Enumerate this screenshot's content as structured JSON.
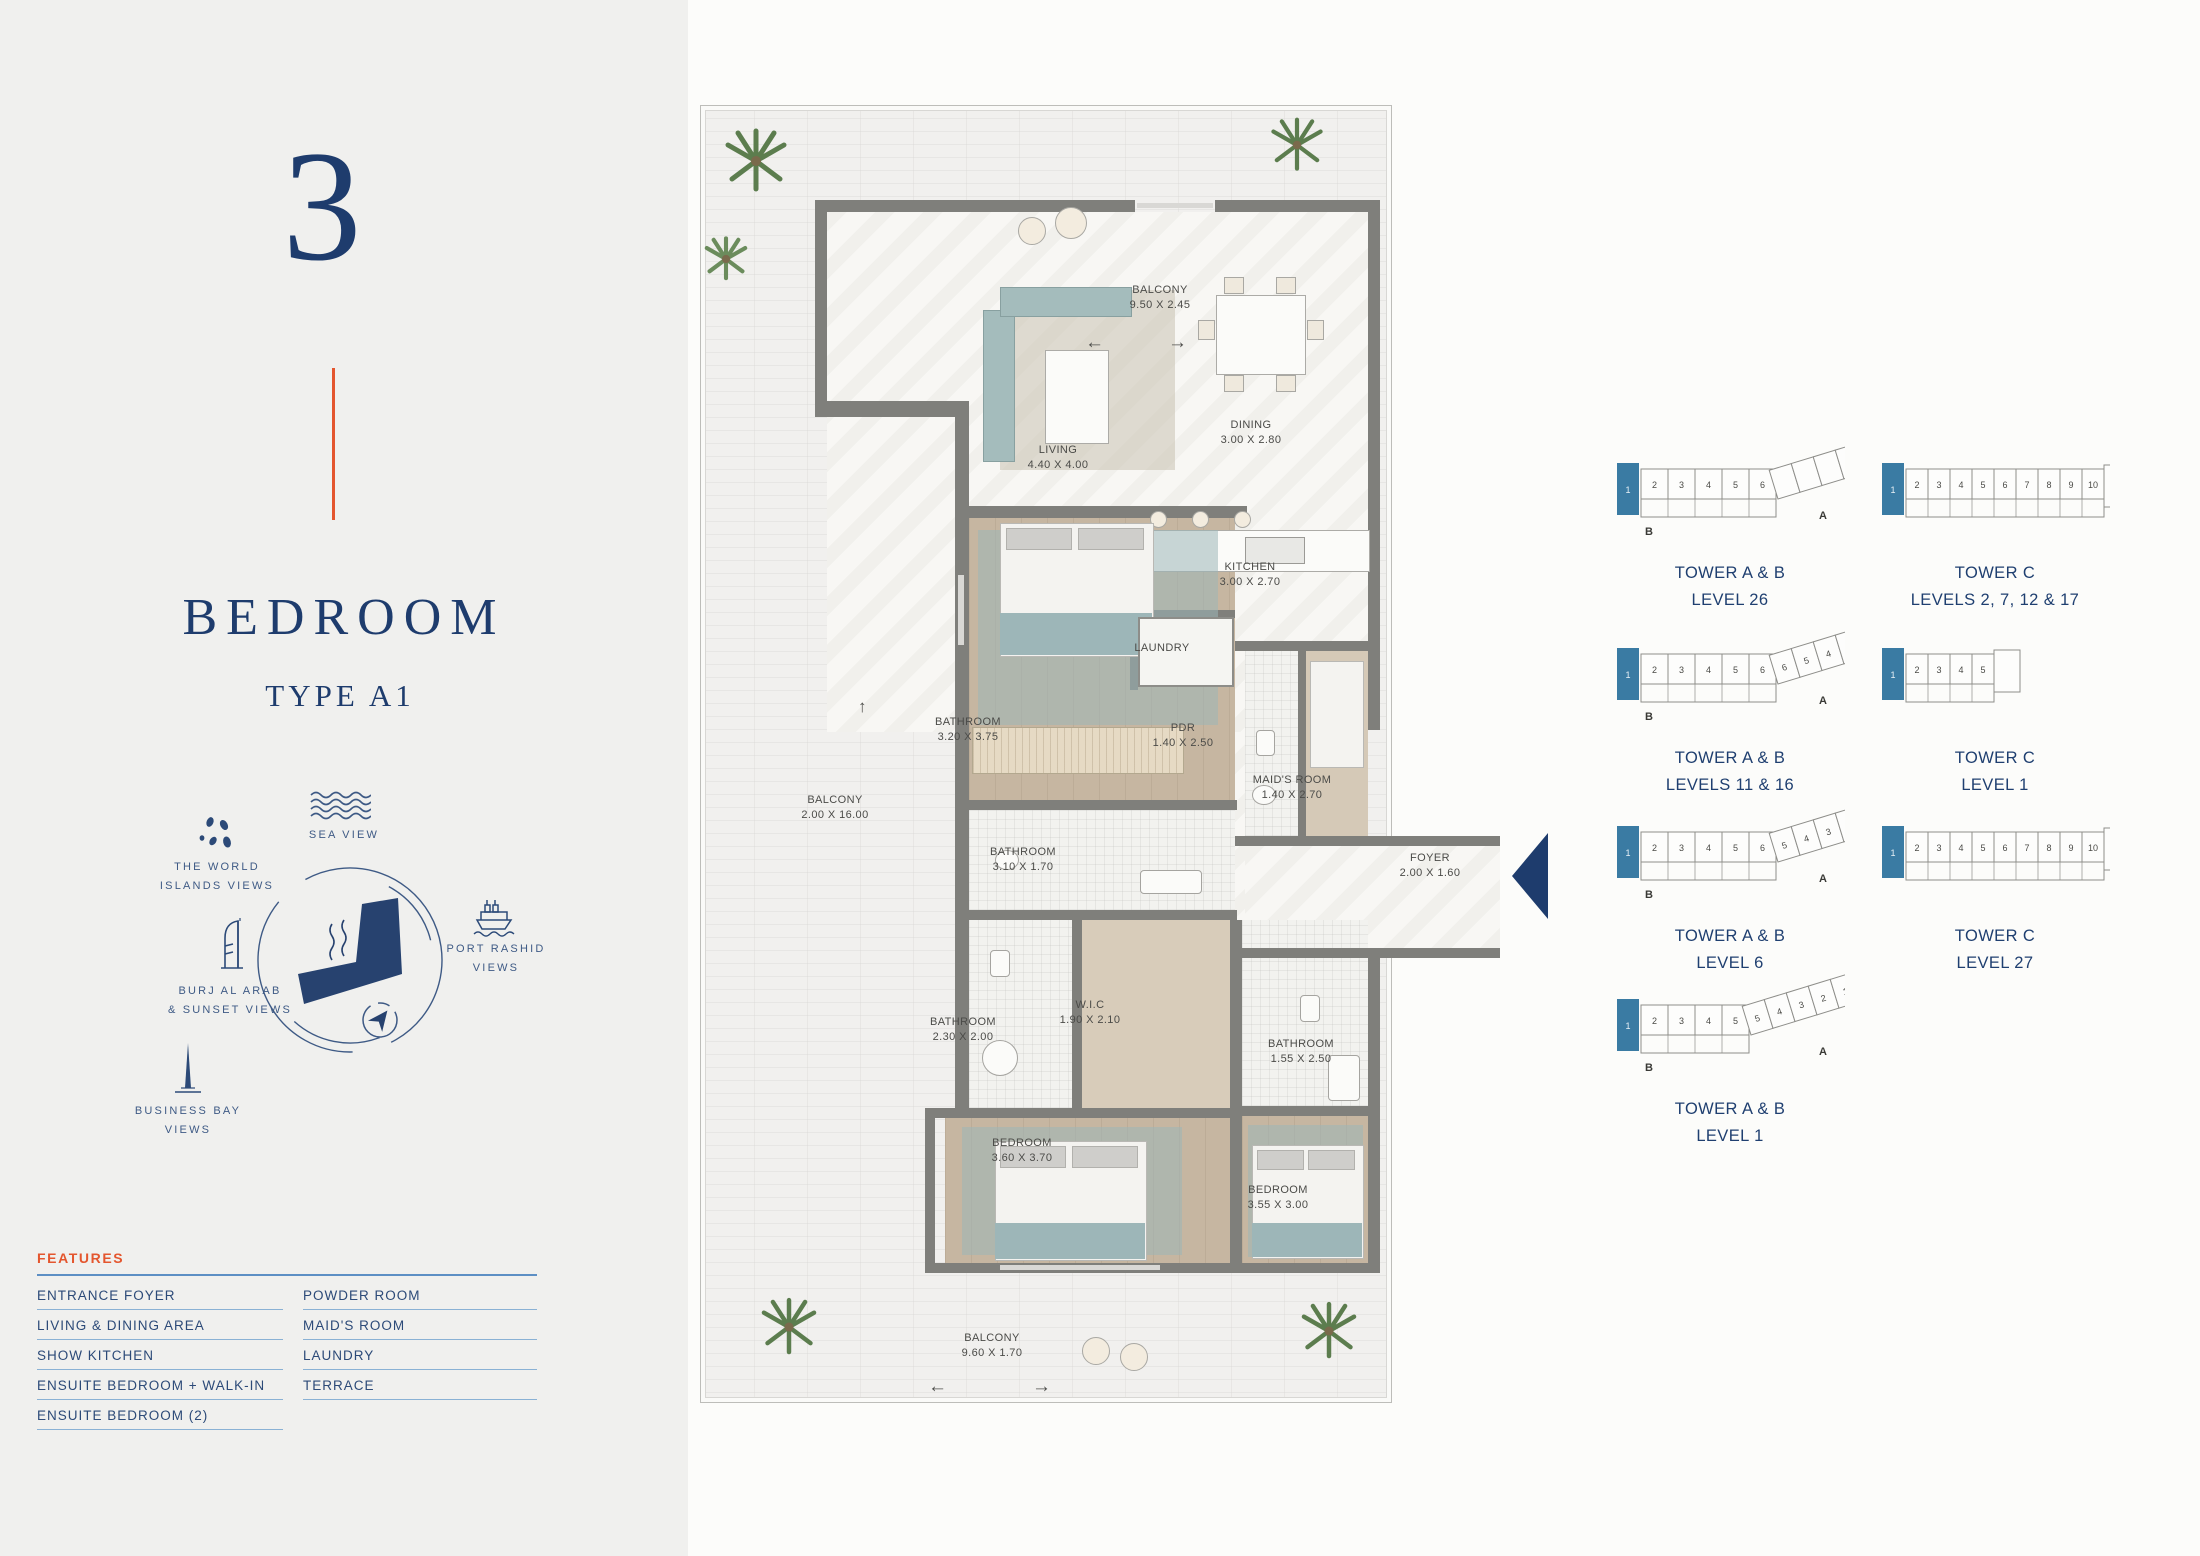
{
  "page": {
    "unit_number": "3",
    "title": "BEDROOM",
    "subtitle": "TYPE A1"
  },
  "views": {
    "sea": [
      "SEA VIEW"
    ],
    "world": [
      "THE WORLD",
      "ISLANDS VIEWS"
    ],
    "port": [
      "PORT RASHID",
      "VIEWS"
    ],
    "burj": [
      "BURJ AL ARAB",
      "& SUNSET VIEWS"
    ],
    "bay": [
      "BUSINESS BAY",
      "VIEWS"
    ]
  },
  "features": {
    "heading": "FEATURES",
    "left": [
      "ENTRANCE FOYER",
      "LIVING & DINING AREA",
      "SHOW KITCHEN",
      "ENSUITE BEDROOM + WALK-IN",
      "ENSUITE BEDROOM (2)"
    ],
    "right": [
      "POWDER ROOM",
      "MAID'S ROOM",
      "LAUNDRY",
      "TERRACE"
    ]
  },
  "floorplan": {
    "north_arrow": "↑",
    "arrow_left": "←",
    "arrow_right": "→",
    "rooms": [
      {
        "n": "BALCONY",
        "d": "9.50 X 2.45",
        "x": 460,
        "y": 178
      },
      {
        "n": "LIVING",
        "d": "4.40 X 4.00",
        "x": 358,
        "y": 338
      },
      {
        "n": "DINING",
        "d": "3.00 X 2.80",
        "x": 551,
        "y": 313
      },
      {
        "n": "KITCHEN",
        "d": "3.00 X 2.70",
        "x": 550,
        "y": 455
      },
      {
        "n": "LAUNDRY",
        "d": "",
        "x": 462,
        "y": 536
      },
      {
        "n": "BATHROOM",
        "d": "3.20 X 3.75",
        "x": 268,
        "y": 610
      },
      {
        "n": "PDR",
        "d": "1.40 X 2.50",
        "x": 483,
        "y": 616
      },
      {
        "n": "MAID'S ROOM",
        "d": "1.40 X 2.70",
        "x": 592,
        "y": 668
      },
      {
        "n": "BALCONY",
        "d": "2.00 X 16.00",
        "x": 135,
        "y": 688
      },
      {
        "n": "BATHROOM",
        "d": "3.10 X 1.70",
        "x": 323,
        "y": 740
      },
      {
        "n": "FOYER",
        "d": "2.00 X 1.60",
        "x": 730,
        "y": 746
      },
      {
        "n": "BATHROOM",
        "d": "2.30 X 2.00",
        "x": 263,
        "y": 910
      },
      {
        "n": "W.I.C",
        "d": "1.90 X 2.10",
        "x": 390,
        "y": 893
      },
      {
        "n": "BATHROOM",
        "d": "1.55 X 2.50",
        "x": 601,
        "y": 932
      },
      {
        "n": "BEDROOM",
        "d": "3.60 X 3.70",
        "x": 322,
        "y": 1031
      },
      {
        "n": "BEDROOM",
        "d": "3.55 X 3.00",
        "x": 578,
        "y": 1078
      },
      {
        "n": "BALCONY",
        "d": "9.60 X 1.70",
        "x": 292,
        "y": 1226
      }
    ]
  },
  "towers": [
    {
      "type": "ab",
      "main": [
        2,
        3,
        4,
        5,
        6
      ],
      "wing": [],
      "caption1": "TOWER A & B",
      "caption2": "LEVEL 26",
      "left": 1615,
      "top": 437
    },
    {
      "type": "c",
      "main": [
        2,
        3,
        4,
        5,
        6,
        7,
        8,
        9,
        10
      ],
      "extra": "11",
      "caption1": "TOWER C",
      "caption2": "LEVELS 2, 7, 12 & 17",
      "left": 1880,
      "top": 437
    },
    {
      "type": "ab",
      "main": [
        2,
        3,
        4,
        5,
        6
      ],
      "wing": [
        6,
        5,
        4,
        3,
        2,
        1
      ],
      "caption1": "TOWER A & B",
      "caption2": "LEVELS 11 & 16",
      "left": 1615,
      "top": 622
    },
    {
      "type": "c",
      "main": [
        2,
        3,
        4,
        5
      ],
      "extra": "",
      "caption1": "TOWER C",
      "caption2": "LEVEL 1",
      "left": 1880,
      "top": 622
    },
    {
      "type": "ab",
      "main": [
        2,
        3,
        4,
        5,
        6
      ],
      "wing": [
        5,
        4,
        3,
        2,
        1
      ],
      "caption1": "TOWER A & B",
      "caption2": "LEVEL 6",
      "left": 1615,
      "top": 800
    },
    {
      "type": "c",
      "main": [
        2,
        3,
        4,
        5,
        6,
        7,
        8,
        9,
        10
      ],
      "extra": "",
      "caption1": "TOWER C",
      "caption2": "LEVEL 27",
      "left": 1880,
      "top": 800
    },
    {
      "type": "ab",
      "main": [
        2,
        3,
        4,
        5
      ],
      "wing": [
        5,
        4,
        3,
        2,
        1
      ],
      "caption1": "TOWER A & B",
      "caption2": "LEVEL 1",
      "left": 1615,
      "top": 973
    }
  ],
  "tower_unit_highlight": "1",
  "tower_letters": {
    "a": "A",
    "b": "B"
  },
  "colors": {
    "navy": "#1e3c6d",
    "orange": "#e4562e",
    "teal_unit": "#3a7ba3",
    "feature_rule": "#5d8fc4",
    "feature_underline": "#8ab1d4",
    "wall": "#7f7f7b"
  }
}
